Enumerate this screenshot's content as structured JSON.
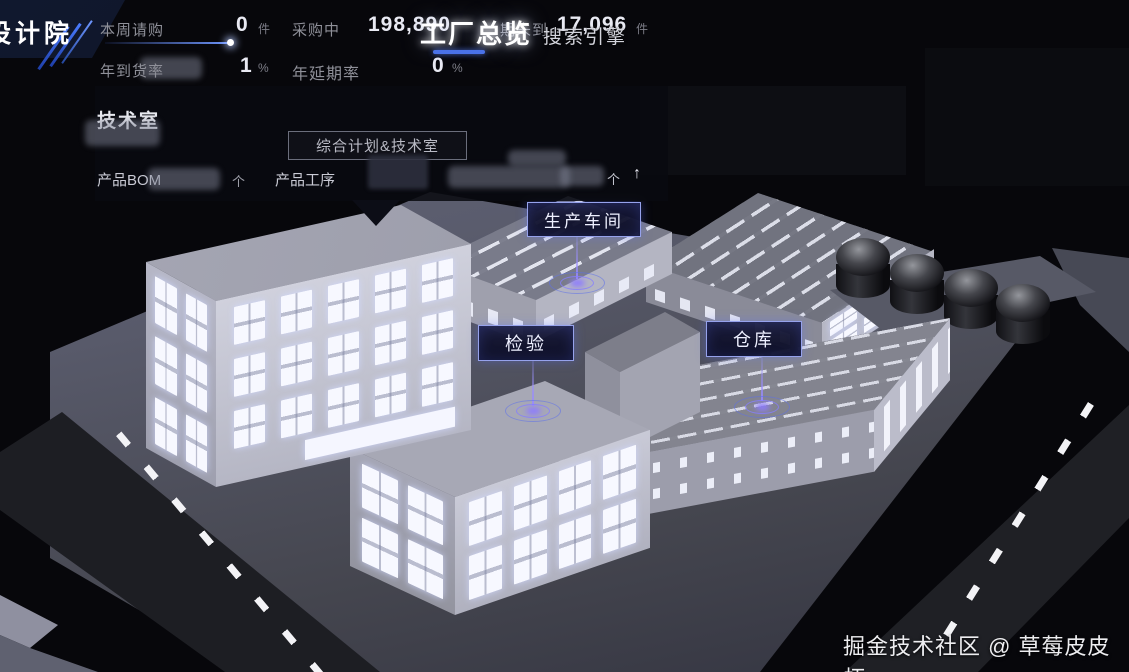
{
  "header": {
    "logo_text": "设计院",
    "title": "工厂总览",
    "search_label": "搜索引擎",
    "stats_row1": [
      {
        "label": "本周请购",
        "value": "0",
        "unit": "件"
      },
      {
        "label": "采购中",
        "value": "198,890",
        "unit": ""
      },
      {
        "label": "期未到",
        "value": "17,096",
        "unit": "件"
      }
    ],
    "stats_row2": [
      {
        "label": "年到货率",
        "value": "1",
        "unit": "%"
      },
      {
        "label": "年延期率",
        "value": "0",
        "unit": "%"
      }
    ]
  },
  "tooltip": {
    "section_title": "技术室",
    "dept_label": "综合计划&技术室",
    "stat1_label": "产品BOM",
    "stat1_unit": "个",
    "stat2_label": "产品工序",
    "stat2_unit": "个",
    "trend_arrow": "↑"
  },
  "scene": {
    "labels": {
      "production": "生产车间",
      "inspection": "检验",
      "warehouse": "仓库"
    }
  },
  "watermark": "掘金技术社区 @ 草莓皮皮虾",
  "colors": {
    "accent_blue": "#4a72e8",
    "label_border": "#96a2ec",
    "window_glow": "#f6f7ff"
  }
}
